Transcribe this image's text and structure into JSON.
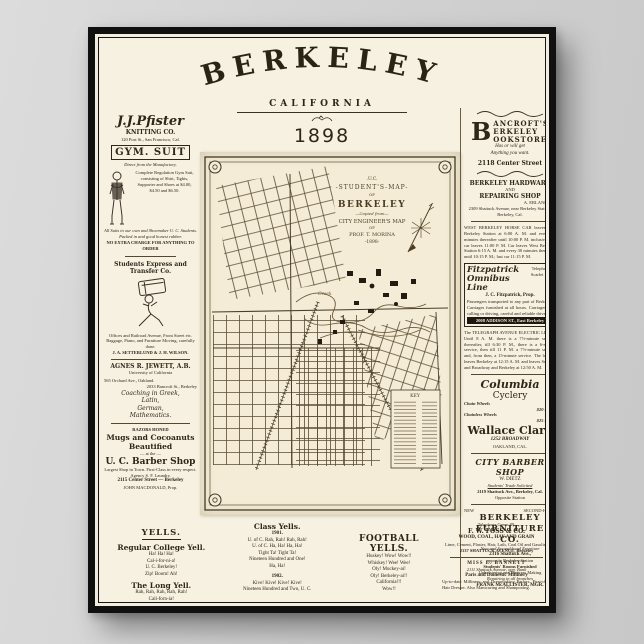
{
  "colors": {
    "paper": "#f7f1e2",
    "ink": "#2e2718",
    "map_paper": "#f4ecd6",
    "frame": "#101010",
    "background": "#d2d2d2"
  },
  "header": {
    "title": "BERKELEY",
    "subtitle": "CALIFORNIA",
    "year": "1898"
  },
  "left": {
    "pfister": {
      "name": "J.J.Pfister",
      "name2": "KNITTING CO.",
      "addr": "120 Post St., San Francisco, Cal.",
      "box": "GYM. SUIT",
      "tagline": "Direct from the Manufactory.",
      "body": "Complete Regulation Gym Suit, consisting of Shirt, Tights, Supporter and Shoes at $4.00, $4.50 and $6.50.",
      "note": "All Suits in our own and Shoemaker U. C. Students. Packed in and good honest rubber.",
      "footer": "NO EXTRA CHARGE FOR ANYTHING TO ORDER"
    },
    "express": {
      "title": "Students Express and Transfer Co.",
      "body": "Offices and Railroad Avenue, Front Street etc. Baggage, Piano, and Furniture Moving, carefully done.",
      "footer": "J. A. SETTERLUND & J. H. WILSON."
    },
    "jewett": {
      "title": "AGNES R. JEWETT, A.B.",
      "sub": "University of California",
      "addr1": "565 Orchard Ave., Oakland.",
      "addr2": "2033 Bancroft St., Berkeley",
      "s1": "Coaching in Greek,",
      "s2": "Latin,",
      "s3": "German,",
      "s4": "Mathematics."
    },
    "barber": {
      "razors": "RAZORS HONED",
      "line1": "Mugs and Cocoanuts",
      "line2": "Beautified",
      "at": "— at the —",
      "title": "U. C. Barber Shop",
      "body": "Largest Shop in Town. First-Class in every respect. Agency S. F. Laundry.",
      "addr": "2115 Center Street — Berkeley",
      "prop": "JOHN MACDONALD, Prop."
    }
  },
  "map": {
    "cartouche": {
      "l1": ".U.C.",
      "l2": "-STUDENT'S-MAP-",
      "l3": "OF",
      "l4": "BERKELEY",
      "l5": "—Copied from—",
      "l6": "CITY ENGINEER'S MAP",
      "l7": "OF",
      "l8": "PROF. T. MORINA",
      "l9": "-1898-"
    },
    "key_title": "KEY",
    "creek_label": "Creek"
  },
  "right": {
    "bancroft": {
      "dropcap": "B",
      "l1": "ANCROFT'S",
      "l2": "ERKELEY",
      "l3": "OOKSTORE",
      "tag1": "Has or will get",
      "tag2": "Anything you want.",
      "addr": "2118 Center Street"
    },
    "hardware": {
      "l1": "BERKELEY HARDWARE",
      "l2": "AND",
      "l3": "REPAIRING SHOP",
      "prop": "A. ERLANDSEN",
      "addr": "2309 Shattuck Avenue, near Berkeley Station, Berkeley, Cal."
    },
    "horsecar": "WEST BERKELEY HORSE CAR leaves East Berkeley Station at 6:00 A. M. and every 30 minutes thereafter until 10:00 P. M. inclusive; last car leaves 11:00 P. M. Car leaves West Berkeley Station 6:15 A. M. and every 30 minutes thereafter until 10:15 P. M.; last car 11:15 P. M.",
    "fitz": {
      "n1": "Fitzpatrick",
      "n2": "Omnibus Line",
      "phone": "Telephone Scarlet 111",
      "prop": "J. C. Fitzpatrick, Prop.",
      "body": "Passengers transported to any part of Berkeley. Carriages furnished at all hours. Carriages for calling or driving, careful and reliable drivers.",
      "addr": "2008 ADDISON ST., East Berkeley"
    },
    "electric": "The TELEGRAPH AVENUE ELECTRIC LINE—Until 8 A. M. there is a 7½-minute service; thereafter, till 6:30 P. M., there is a 6-minute service, then till 11 P. M. a 7½-minute service, and, from then, a 15-minute service. The last car leaves Berkeley at 12:15 A. M. and leaves Seventh and Broadway and Berkeley at 12:50 A. M.",
    "cyclery": {
      "brand": "Columbia",
      "brand2": "Cyclery",
      "chain_label": "Chain Wheels",
      "chain_price": "$20 to $50",
      "chainless_label": "Chainless Wheels",
      "chainless_price": "$25 to $75",
      "name": "Wallace Clark",
      "addr": "1252 BROADWAY",
      "city": "OAKLAND, CAL."
    },
    "citybarber": {
      "title": "CITY BARBER SHOP",
      "prop": "W. DIETZ",
      "tag": "Students' Trade Solicited",
      "addr": "2119 Shattuck Ave., Berkeley, Cal.",
      "sub": "Opposite Station"
    },
    "furniture": {
      "top_left": "NEW",
      "top_right": "SECOND-HAND",
      "t1": "BERKELEY",
      "t2": "FURNITURE  CO.",
      "tag": "New and Second-hand Furniture",
      "addr1": "2316 Shattuck Ave.,",
      "addr2": "opposite Berkeley Station",
      "b1": "Students' Rooms Furnished",
      "b2": "Upholstering and Mattress Making",
      "b3": "Repairing in all branches",
      "mgr": "FRANK McALLISTER, MGR."
    }
  },
  "bottom": {
    "yells_title": "YELLS.",
    "regular": {
      "title": "Regular College Yell.",
      "lines": [
        "Ha! Ha! Ha!",
        "Cal-i-for-ni-a!",
        "U. C. Berkeley!",
        "Zip! Boom! Ah!"
      ]
    },
    "long": {
      "title": "The Long Yell.",
      "lines": [
        "Rah, Rah, Rah, Rah, Rah!",
        "Cali-forn-ia!",
        "Cali-forn-yah!!",
        "Cali-forn-yah!!!"
      ]
    },
    "cls": {
      "title": "Class Yells.",
      "y1": "1901.",
      "lines1": [
        "U. of C. Rah, Rah! Rah, Rah!",
        "U. of C. Ha, Ha! Ha, Ha!",
        "Tight Ta! Tight Ta!",
        "Nineteen Hundred and One!",
        "Ha, Ha!"
      ],
      "y2": "1902.",
      "lines2": [
        "Kive! Kive! Kive! Kive!",
        "Nineteen Hundred and Two, U. C."
      ]
    },
    "football": {
      "title": "FOOTBALL YELLS.",
      "lines": [
        "Huskey! Wow! Wow!!",
        "Whiskey! Wee! Wee!",
        "Oly! Muckey-ai!",
        "Oly! Berkeley-ai!!",
        "California!!!",
        "Wow!!"
      ]
    },
    "foss": {
      "phone": "Telephone Green 89.",
      "title": "F. W. FOSS & CO.",
      "sub": "WOOD, COAL, HAY AND GRAIN",
      "body": "Lime, Cement, Plaster, Hair, Lath, Coal Oil and Gasoline",
      "addr": "2137 SHATTUCK AVENUE, Berkeley"
    },
    "bannett": {
      "title": "MISS E. BANNETT",
      "addr": "2111 Shattuck Avenue, opp. Bank",
      "sub": "Paris and Domestic Millinery",
      "body": "Up-to-date Millinery and Dressmaking Parlors. First-class Hair Dresser. Also Manicuring and Shampooing."
    }
  }
}
